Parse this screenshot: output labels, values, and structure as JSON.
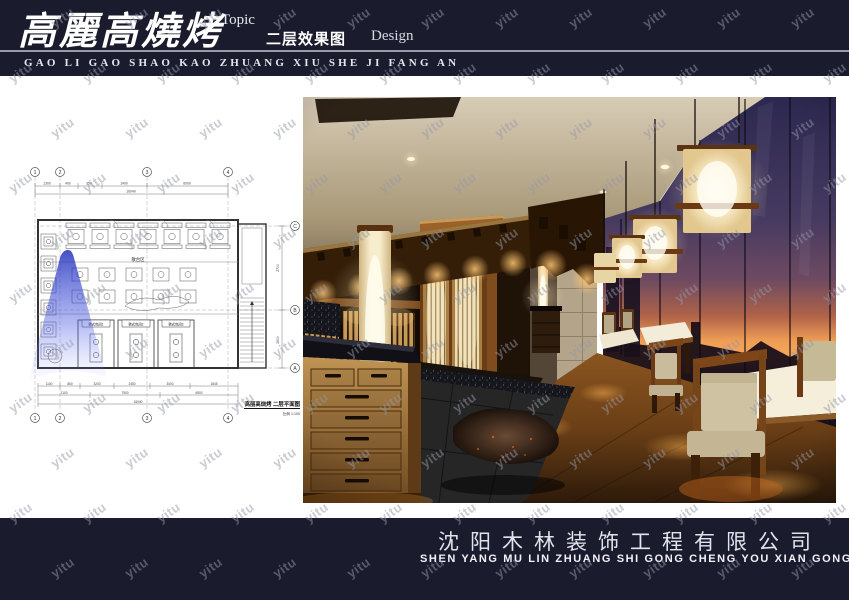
{
  "header": {
    "title": "高麗高燒烤",
    "topic_label": "Topic",
    "subtitle": "二层效果图",
    "design_label": "Design",
    "pinyin": "GAO LI GAO SHAO KAO ZHUANG XIU SHE JI FANG AN"
  },
  "plan": {
    "grid_top": [
      "1",
      "2",
      "3",
      "4"
    ],
    "grid_bottom": [
      "1",
      "2",
      "3",
      "4"
    ],
    "grid_right": [
      "C",
      "B",
      "A"
    ],
    "room_labels": [
      "韩式包间1",
      "韩式包间2",
      "韩式包间3"
    ],
    "area_label": "散台区",
    "dims_top": [
      "1300",
      "400",
      "350",
      "1400",
      "6000"
    ],
    "dim_top_total": "16040",
    "dims_bottom_row1": [
      "1100",
      "860",
      "3200",
      "2450",
      "3000",
      "1845"
    ],
    "dims_bottom_row2": [
      "2100",
      "7900",
      "6900"
    ],
    "dim_bottom_total": "16040",
    "dims_right": [
      "2700",
      "2600"
    ],
    "caption_title": "高丽高烧烤  二层平面图",
    "caption_scale": "比例 1:100"
  },
  "footer": {
    "company_cn": "沈阳木林装饰工程有限公司",
    "company_pinyin": "SHEN YANG MU LIN ZHUANG SHI GONG CHENG YOU XIAN GONG SI"
  },
  "watermark": {
    "text": "yitu"
  },
  "colors": {
    "band_bg": "#1b1b2e",
    "header_rule": "#9a9aa8",
    "watermark": "rgba(150,152,168,0.5)",
    "view_cone_blue": "#2a3bd0",
    "sunset_orange": "#f0a055",
    "sky_purple": "#34305c",
    "lamp_cream": "#f6e7c0",
    "wood_warm": "#8a5520"
  }
}
